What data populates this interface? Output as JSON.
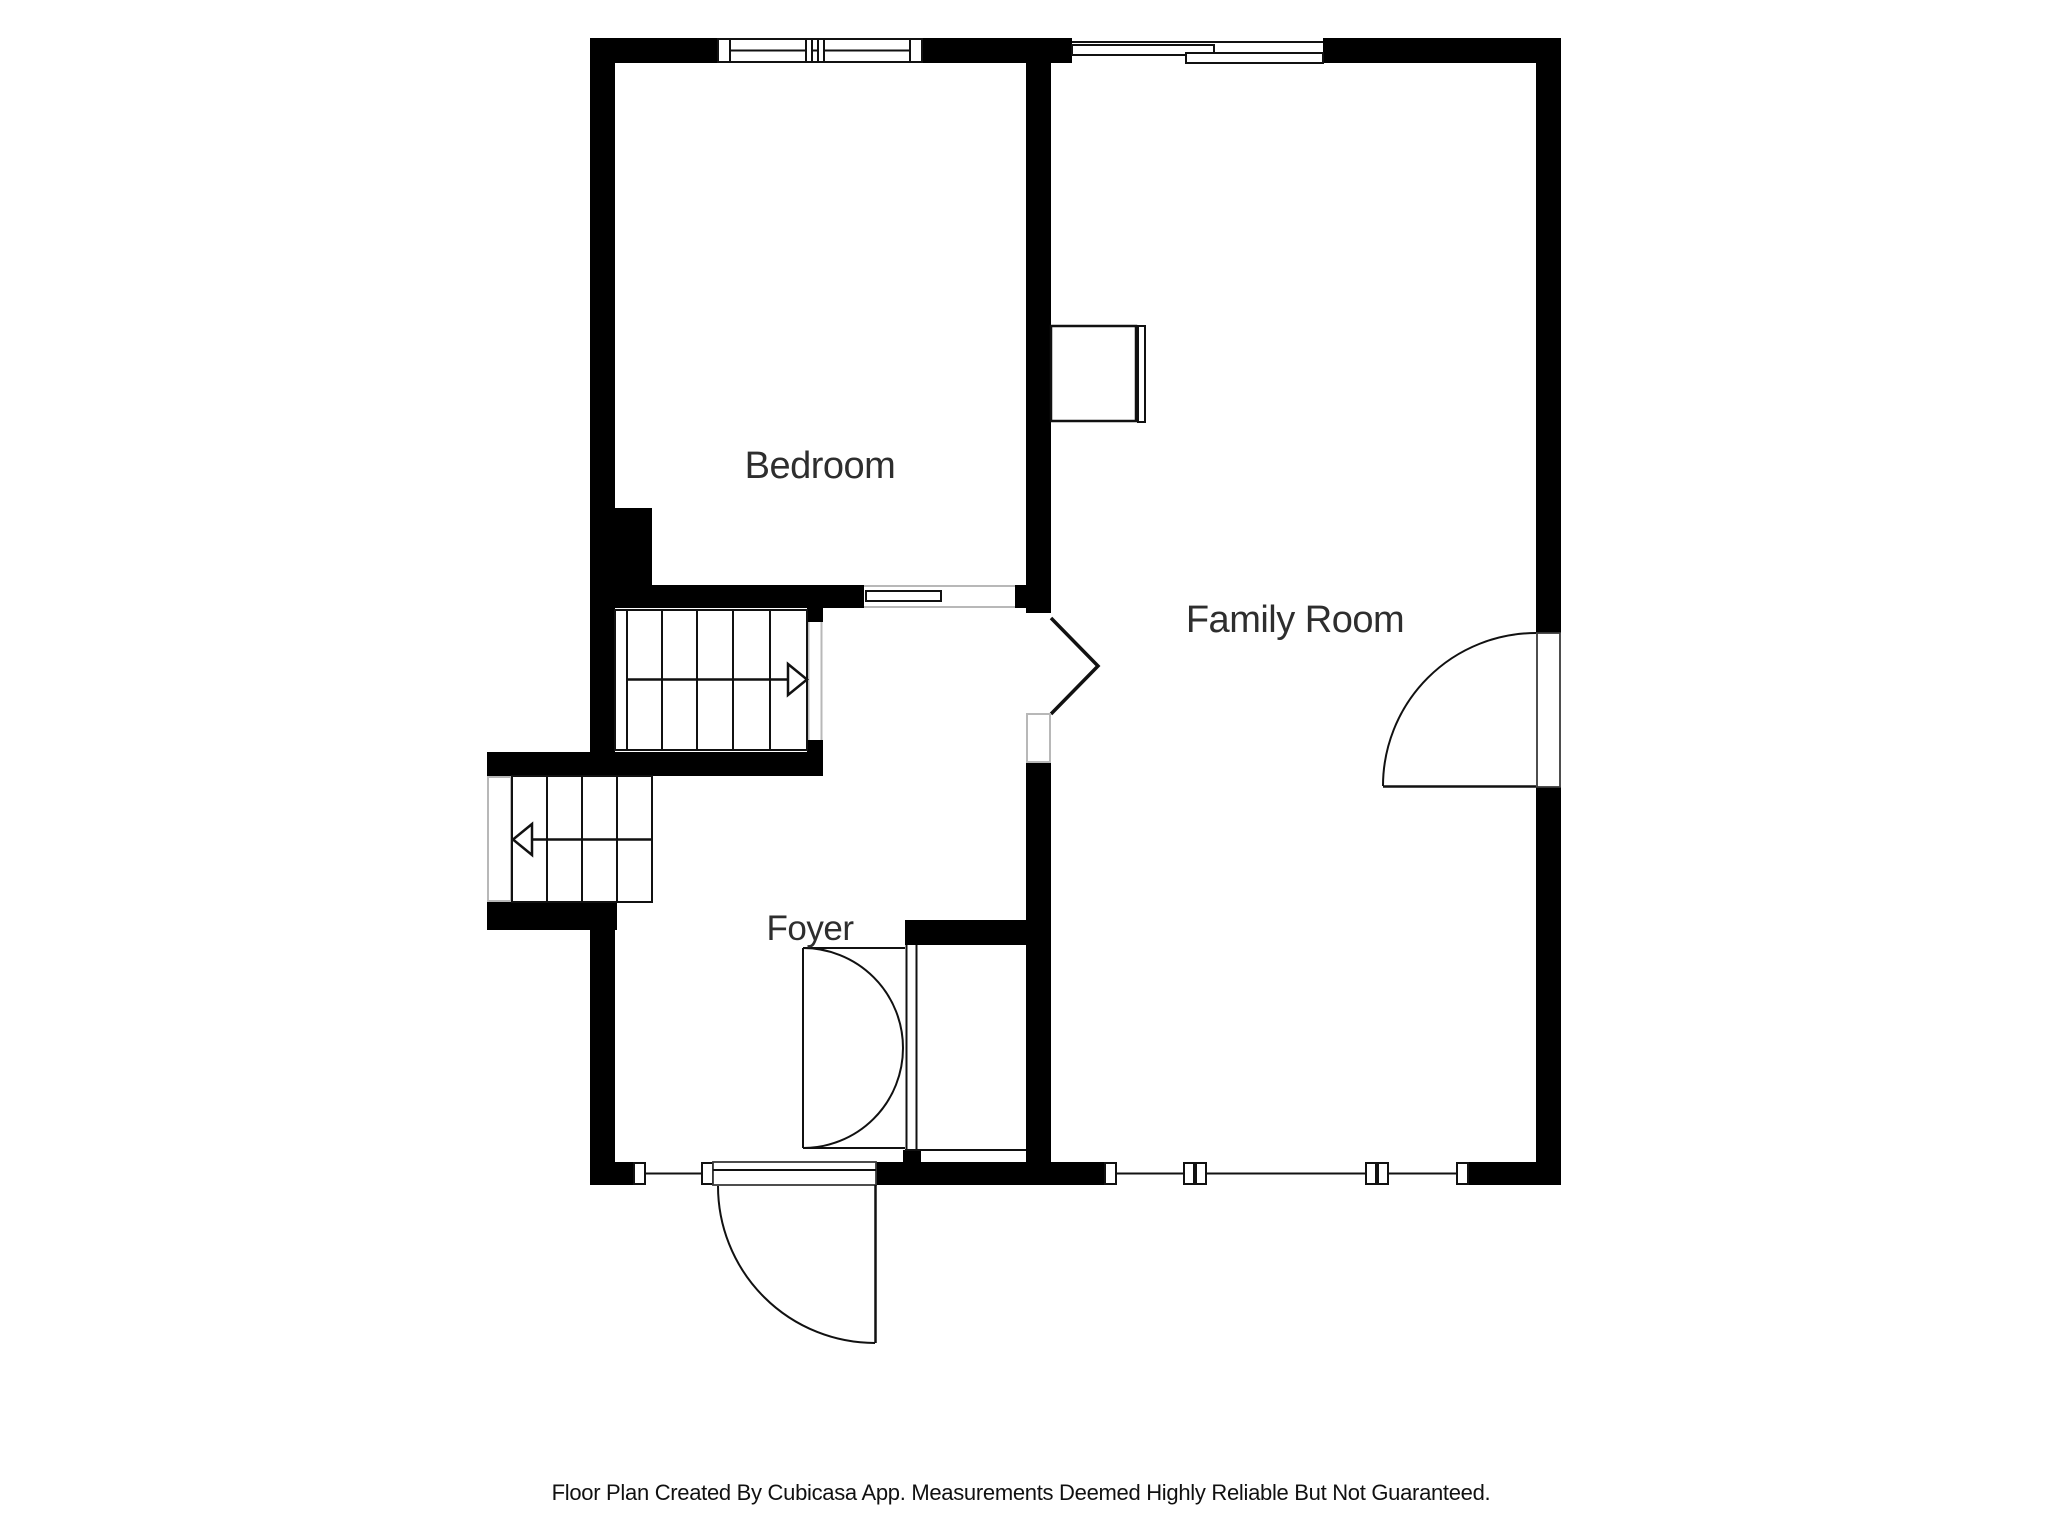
{
  "floor_plan": {
    "rooms": [
      {
        "label": "Bedroom"
      },
      {
        "label": "Family Room"
      },
      {
        "label": "Foyer"
      }
    ],
    "footer": "Floor Plan Created By Cubicasa App. Measurements Deemed Highly Reliable But Not Guaranteed.",
    "features": {
      "upper_staircase": "stairs-up-arrow-right",
      "lower_staircase": "stairs-down-arrow-left",
      "entry_door": "exterior-swing-door",
      "family_room_door": "right-wall-swing-door",
      "hall_opening": "pocket-door-opening",
      "closet_doors": "double-arc-doors",
      "fireplace_fixture": "wall-mounted-rectangle"
    },
    "colors": {
      "background": "#ffffff",
      "wall": "#000000",
      "line": "#111111",
      "light_frame": "#b8b8b8",
      "label_text": "#2e2e2e",
      "footer_text": "#111111"
    }
  }
}
